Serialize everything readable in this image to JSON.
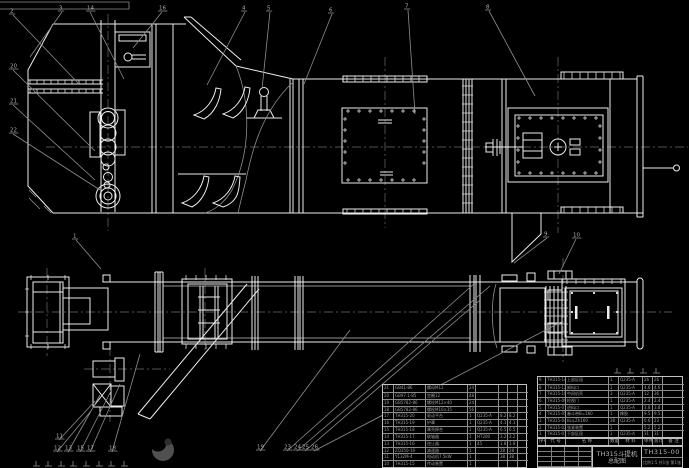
{
  "title_block": {
    "product_title": "TH315斗提机",
    "sheet_title": "总配图",
    "drawing_number": "TH315-00",
    "note_row": "比例1:5 共1张 第1张"
  },
  "bom_header": {
    "cells": [
      "序号",
      "代 号",
      "名 称",
      "数量",
      "材 料",
      "单件",
      "总计",
      "备 注"
    ]
  },
  "bom_left": {
    "rows": [
      [
        "21",
        "GB41-86",
        "螺母M12",
        "24",
        "",
        "",
        "",
        ""
      ],
      [
        "20",
        "GB97.1-85",
        "垫圈12",
        "48",
        "",
        "",
        "",
        ""
      ],
      [
        "19",
        "GB5782-86",
        "螺栓M12×40",
        "24",
        "",
        "",
        "",
        ""
      ],
      [
        "18",
        "GB5782-86",
        "螺栓M10×35",
        "56",
        "",
        "",
        "",
        ""
      ],
      [
        "17",
        "TH315-20",
        "驱动平台",
        "1",
        "Q235-A",
        "8.2",
        "8.2",
        ""
      ],
      [
        "16",
        "TH315-19",
        "护罩",
        "1",
        "Q235-A",
        "4.1",
        "4.1",
        ""
      ],
      [
        "15",
        "TH315-18",
        "罩壳焊合",
        "1",
        "Q235-A",
        "6.5",
        "6.5",
        ""
      ],
      [
        "14",
        "TH315-17",
        "联轴器",
        "1",
        "HT200",
        "3.2",
        "3.2",
        ""
      ],
      [
        "13",
        "TH315-16",
        "逆止器",
        "1",
        "45",
        "1.8",
        "1.8",
        ""
      ],
      [
        "12",
        "ZQ350-16",
        "减速器",
        "1",
        "",
        "28",
        "28",
        ""
      ],
      [
        "11",
        "Y132M-4",
        "电动机7.5kW",
        "1",
        "",
        "38",
        "38",
        ""
      ],
      [
        "10",
        "TH315-15",
        "传动装置",
        "1",
        "",
        "",
        "",
        ""
      ]
    ]
  },
  "bom_right": {
    "rows": [
      [
        "9",
        "TH315-14",
        "上部区段",
        "1",
        "Q235-A",
        "26",
        "26",
        ""
      ],
      [
        "8",
        "TH315-12",
        "卸料口",
        "1",
        "Q235-A",
        "4.6",
        "4.6",
        ""
      ],
      [
        "7",
        "TH315-10",
        "中间机壳",
        "3",
        "Q235-A",
        "12",
        "36",
        ""
      ],
      [
        "6",
        "TH315-09",
        "检视门",
        "1",
        "Q235-A",
        "2.4",
        "2.4",
        ""
      ],
      [
        "5",
        "TH315-07",
        "进料口",
        "1",
        "Q235-A",
        "3.8",
        "3.8",
        ""
      ],
      [
        "4",
        "TH315-05",
        "畚斗带B=160",
        "1",
        "橡胶",
        "9.5",
        "9.5",
        ""
      ],
      [
        "3",
        "TH315-04",
        "料斗Zh160",
        "38",
        "Q235-A",
        "0.6",
        "23",
        ""
      ],
      [
        "2",
        "TH315-02",
        "张紧装置",
        "1",
        "",
        "5.2",
        "5.2",
        ""
      ],
      [
        "1",
        "TH315-01",
        "下部区段",
        "1",
        "Q235-A",
        "31",
        "31",
        ""
      ]
    ]
  },
  "callouts": {
    "labels": [
      "2",
      "3",
      "14",
      "16",
      "4",
      "5",
      "6",
      "7",
      "8",
      "20",
      "21",
      "22",
      "1",
      "9",
      "10",
      "11",
      "12",
      "13",
      "15",
      "17",
      "18",
      "19",
      "23",
      "24",
      "25",
      "26"
    ]
  },
  "colors": {
    "line": "#ededed",
    "leader": "#8f8f8f",
    "centerline": "#6e6e6e",
    "table_text": "#9e9e9e"
  }
}
